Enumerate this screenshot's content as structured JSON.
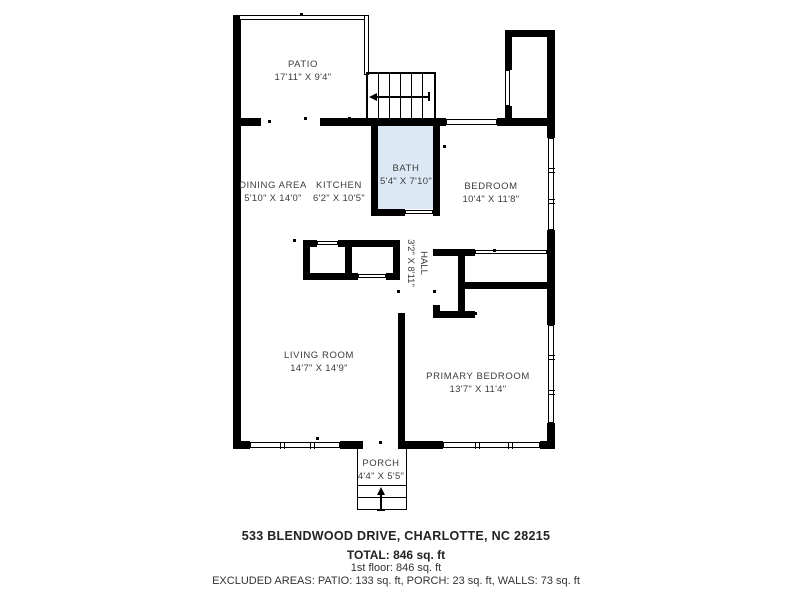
{
  "plan": {
    "rooms": {
      "patio": {
        "name": "PATIO",
        "dims": "17'11\" X 9'4\""
      },
      "dining": {
        "name": "DINING AREA",
        "dims": "5'10\" X 14'0\""
      },
      "kitchen": {
        "name": "KITCHEN",
        "dims": "6'2\" X 10'5\""
      },
      "bath": {
        "name": "BATH",
        "dims": "5'4\" X 7'10\""
      },
      "bedroom": {
        "name": "BEDROOM",
        "dims": "10'4\" X 11'8\""
      },
      "hall": {
        "name": "HALL",
        "dims": "3'2\" X 8'11\""
      },
      "living": {
        "name": "LIVING ROOM",
        "dims": "14'7\" X 14'9\""
      },
      "primary": {
        "name": "PRIMARY BEDROOM",
        "dims": "13'7\" X 11'4\""
      },
      "porch": {
        "name": "PORCH",
        "dims": "4'4\" X 5'5\""
      }
    },
    "colors": {
      "wall": "#000000",
      "bath_fill": "#dce9f5",
      "label_text": "#3c3c3c"
    }
  },
  "footer": {
    "address": "533 BLENDWOOD DRIVE, CHARLOTTE, NC 28215",
    "total": "TOTAL: 846 sq. ft",
    "first_floor": "1st floor: 846 sq. ft",
    "excluded": "EXCLUDED AREAS: PATIO: 133 sq. ft, PORCH: 23 sq. ft, WALLS: 73 sq. ft"
  }
}
